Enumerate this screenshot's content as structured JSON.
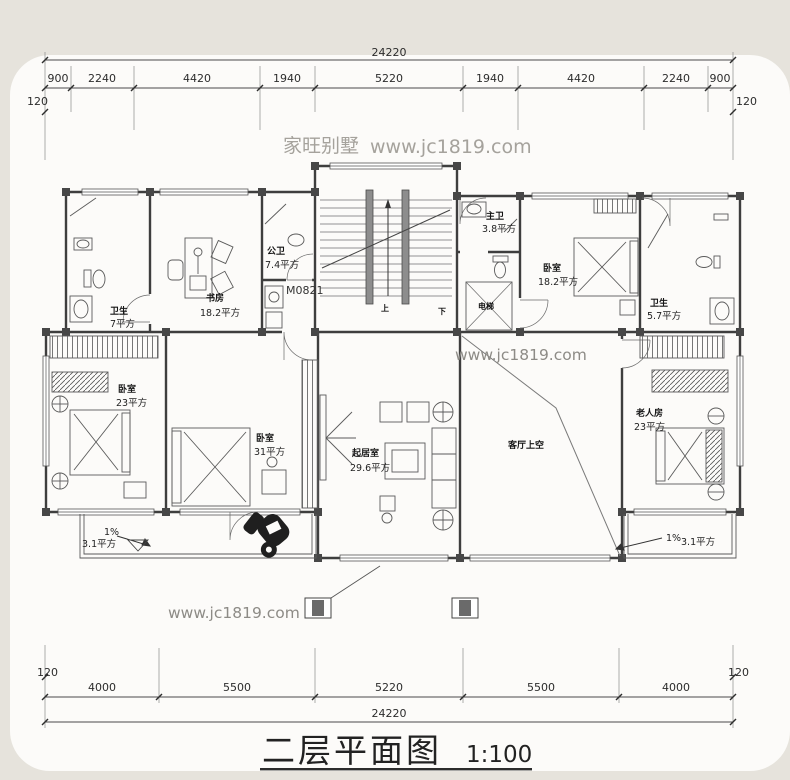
{
  "colors": {
    "page_bg": "#e6e3dc",
    "card_bg": "#fcfbf9",
    "line": "#3e3e3e",
    "watermark": "#a5a29c"
  },
  "watermarks": {
    "brand": "家旺别墅",
    "site": "www.jc1819.com"
  },
  "title": {
    "text": "二层平面图",
    "scale": "1:100"
  },
  "dimensions": {
    "top": {
      "total": "24220",
      "segments": [
        "900",
        "2240",
        "4420",
        "1940",
        "5220",
        "1940",
        "4420",
        "2240",
        "900"
      ],
      "side_left": "120",
      "side_right": "120"
    },
    "bottom": {
      "total": "24220",
      "segments": [
        "4000",
        "5500",
        "5220",
        "5500",
        "4000"
      ],
      "side_left": "120",
      "side_right": "120"
    }
  },
  "rooms": {
    "bath_left": {
      "name": "卫生",
      "area": "7平方"
    },
    "study": {
      "name": "书房",
      "area": "18.2平方"
    },
    "bath_small": {
      "name": "公卫",
      "area": "7.4平方"
    },
    "door_code": "M0821",
    "master_bath": {
      "name": "主卫",
      "area": "3.8平方"
    },
    "elevator": {
      "name": "电梯"
    },
    "bedroom_top_right": {
      "name": "卧室",
      "area": "18.2平方"
    },
    "bath_right": {
      "name": "卫生",
      "area": "5.7平方"
    },
    "bedroom_left": {
      "name": "卧室",
      "area": "23平方"
    },
    "bedroom_mid": {
      "name": "卧室",
      "area": "31平方"
    },
    "living": {
      "name": "起居室",
      "area": "29.6平方"
    },
    "void": {
      "name": "客厅上空"
    },
    "elder_room": {
      "name": "老人房",
      "area": "23平方"
    },
    "balcony_left": {
      "slope": "1%",
      "area": "3.1平方"
    },
    "balcony_right": {
      "slope": "1%",
      "area": "3.1平方"
    },
    "stairs": {
      "up": "上",
      "down": "下"
    }
  }
}
